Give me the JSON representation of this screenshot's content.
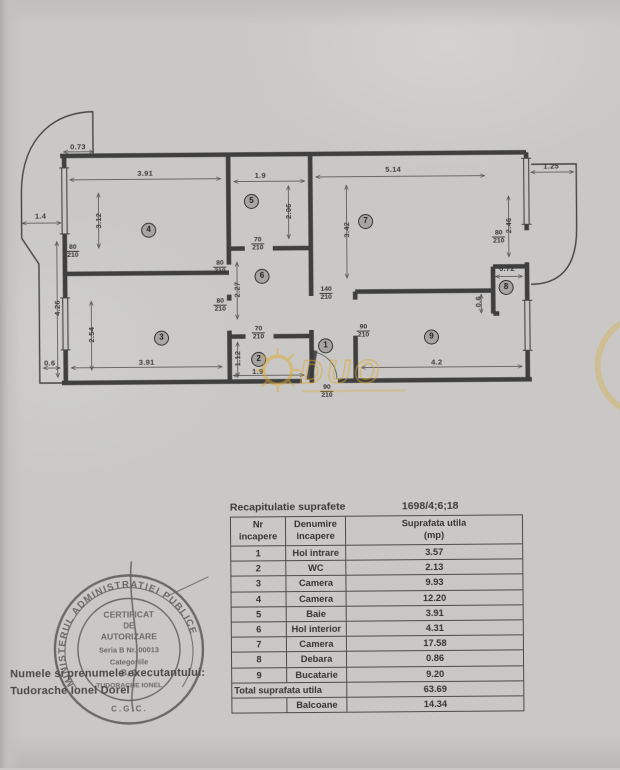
{
  "plan": {
    "dimensions": [
      {
        "text": "0.73",
        "x": 80,
        "y": 145
      },
      {
        "text": "3.91",
        "x": 147,
        "y": 172
      },
      {
        "text": "1.9",
        "x": 262,
        "y": 175
      },
      {
        "text": "5.14",
        "x": 395,
        "y": 170
      },
      {
        "text": "1.25",
        "x": 553,
        "y": 168
      },
      {
        "text": "1.4",
        "x": 42,
        "y": 214
      },
      {
        "text": "3.12",
        "x": 100,
        "y": 219,
        "rot": true
      },
      {
        "text": "2.06",
        "x": 290,
        "y": 211,
        "rot": true
      },
      {
        "text": "3.42",
        "x": 348,
        "y": 230,
        "rot": true
      },
      {
        "text": "2.46",
        "x": 510,
        "y": 227,
        "rot": true
      },
      {
        "text": "2.27",
        "x": 238,
        "y": 289,
        "rot": true
      },
      {
        "text": "4.26",
        "x": 58,
        "y": 306,
        "rot": true
      },
      {
        "text": "2.54",
        "x": 92,
        "y": 333,
        "rot": true
      },
      {
        "text": "1.12",
        "x": 238,
        "y": 358,
        "rot": true
      },
      {
        "text": "3.91",
        "x": 147,
        "y": 361
      },
      {
        "text": "1.9",
        "x": 258,
        "y": 371
      },
      {
        "text": "4.2",
        "x": 437,
        "y": 363
      },
      {
        "text": "0.6",
        "x": 50,
        "y": 361
      },
      {
        "text": "0.72",
        "x": 508,
        "y": 270
      },
      {
        "text": "0.6",
        "x": 479,
        "y": 303,
        "rot": true
      }
    ],
    "door_labels": [
      {
        "w": "80",
        "h": "210",
        "x": 74,
        "y": 242
      },
      {
        "w": "80",
        "h": "210",
        "x": 221,
        "y": 259
      },
      {
        "w": "80",
        "h": "210",
        "x": 221,
        "y": 297
      },
      {
        "w": "70",
        "h": "210",
        "x": 259,
        "y": 236
      },
      {
        "w": "70",
        "h": "210",
        "x": 259,
        "y": 325
      },
      {
        "w": "140",
        "h": "210",
        "x": 327,
        "y": 286
      },
      {
        "w": "90",
        "h": "210",
        "x": 364,
        "y": 324
      },
      {
        "w": "80",
        "h": "210",
        "x": 500,
        "y": 231
      },
      {
        "w": "90",
        "h": "210",
        "x": 327,
        "y": 384
      }
    ],
    "rooms": [
      {
        "n": "1",
        "x": 326,
        "y": 346
      },
      {
        "n": "2",
        "x": 259,
        "y": 359
      },
      {
        "n": "3",
        "x": 162,
        "y": 337
      },
      {
        "n": "4",
        "x": 150,
        "y": 229
      },
      {
        "n": "5",
        "x": 253,
        "y": 201
      },
      {
        "n": "6",
        "x": 263,
        "y": 276
      },
      {
        "n": "7",
        "x": 367,
        "y": 222
      },
      {
        "n": "8",
        "x": 507,
        "y": 289
      },
      {
        "n": "9",
        "x": 432,
        "y": 338
      }
    ],
    "watermark": {
      "text": "DUO"
    }
  },
  "table": {
    "title": "Recapitulatie suprafete",
    "ref": "1698/4;6;18",
    "headers": [
      [
        "Nr",
        "incapere"
      ],
      [
        "Denumire",
        "incapere"
      ],
      [
        "Suprafata utila",
        "(mp)"
      ]
    ],
    "rows": [
      {
        "nr": "1",
        "name": "Hol intrare",
        "area": "3.57"
      },
      {
        "nr": "2",
        "name": "WC",
        "area": "2.13"
      },
      {
        "nr": "3",
        "name": "Camera",
        "area": "9.93"
      },
      {
        "nr": "4",
        "name": "Camera",
        "area": "12.20"
      },
      {
        "nr": "5",
        "name": "Baie",
        "area": "3.91"
      },
      {
        "nr": "6",
        "name": "Hol interior",
        "area": "4.31"
      },
      {
        "nr": "7",
        "name": "Camera",
        "area": "17.58"
      },
      {
        "nr": "8",
        "name": "Debara",
        "area": "0.86"
      },
      {
        "nr": "9",
        "name": "Bucatarie",
        "area": "9.20"
      }
    ],
    "total": {
      "label": "Total suprafata utila",
      "area": "63.69"
    },
    "extra": {
      "nr": "",
      "name": "Balcoane",
      "area": "14.34"
    }
  },
  "stamp": {
    "ring_text": "MINISTERUL ADMINISTRATIEI PUBLICE",
    "bottom_text": "C.G.C.",
    "lines": [
      "CERTIFICAT",
      "DE",
      "AUTORIZARE",
      "Seria B Nr. 00013",
      "Categoriile",
      "B, C",
      "TUDORACHE IONEL"
    ]
  },
  "executor": {
    "label": "Numele si prenumele executantului:",
    "name": "Tudorache Ionel Dorel"
  },
  "colors": {
    "paper": "#c9c8c6",
    "ink": "#3c3c3c",
    "watermark": "#dba72e"
  }
}
